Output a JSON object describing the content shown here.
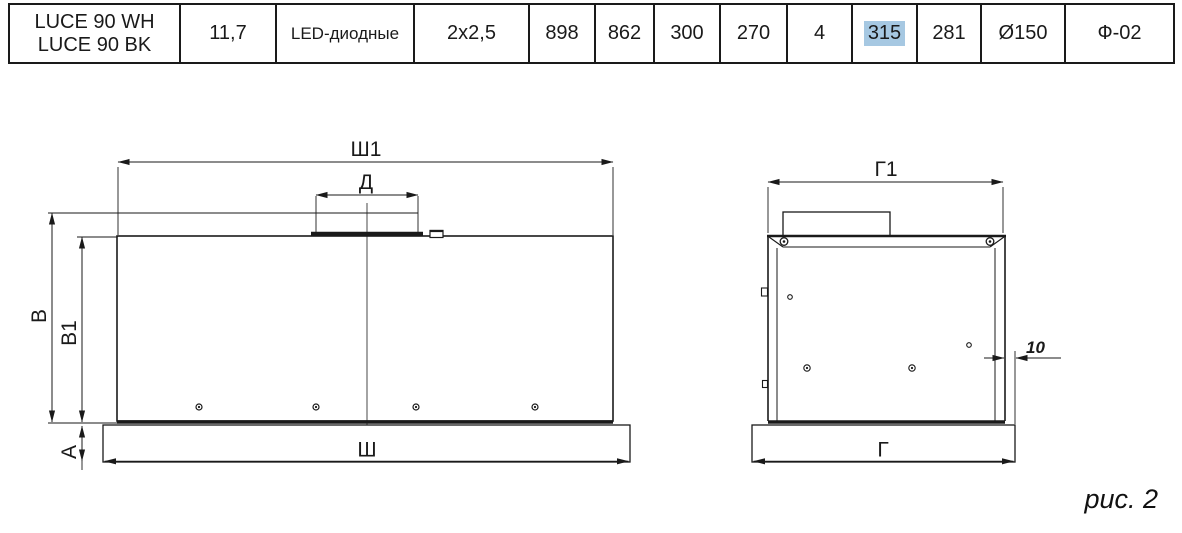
{
  "spec_table": {
    "model": {
      "line1": "LUCE 90 WH",
      "line2": "LUCE 90 BK"
    },
    "values": [
      "11,7",
      "LED-диодные",
      "2x2,5",
      "898",
      "862",
      "300",
      "270",
      "4",
      "315",
      "281",
      "Ø150",
      "Ф-02"
    ],
    "highlight": {
      "value": "315",
      "color": "#a6c8e2"
    }
  },
  "diagram": {
    "front_view": {
      "labels": {
        "overall_width": "Ш1",
        "duct_width": "Д",
        "overall_height": "В",
        "body_height": "В1",
        "panel_height": "А",
        "bottom_width": "Ш"
      }
    },
    "side_view": {
      "labels": {
        "overall_depth": "Г1",
        "bottom_depth": "Г",
        "edge_offset": "10"
      }
    },
    "caption": "рис. 2"
  }
}
